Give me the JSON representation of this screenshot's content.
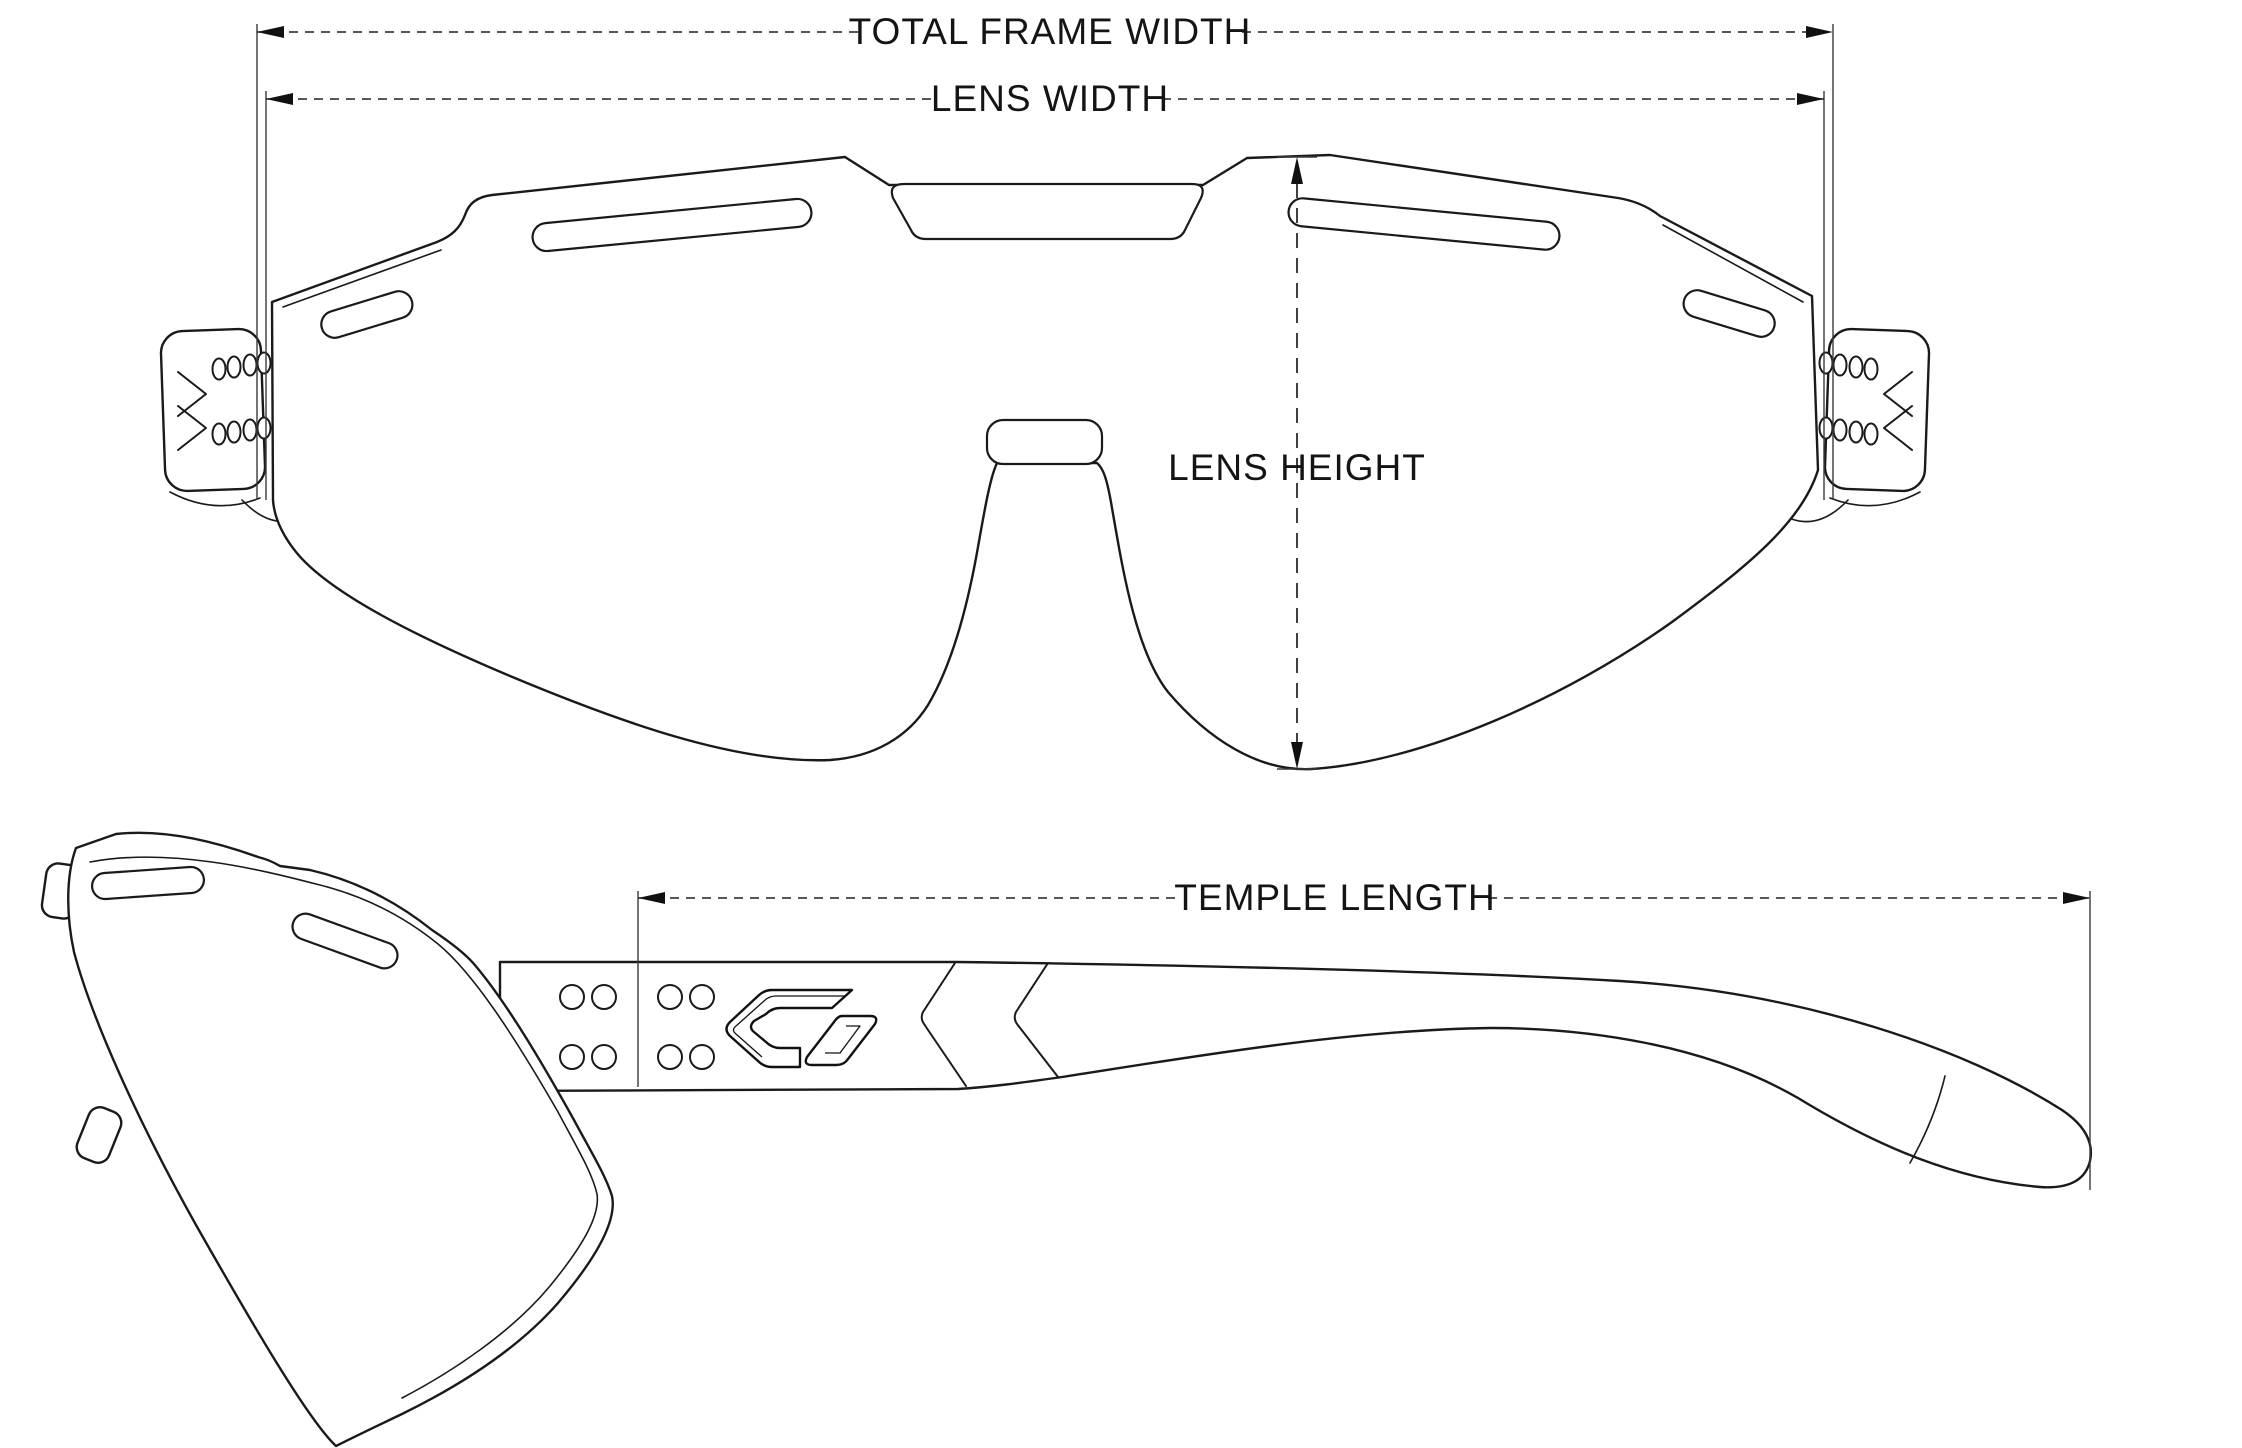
{
  "page": {
    "background_color": "#ffffff",
    "line_color": "#1a1a1a"
  },
  "drawing": {
    "type": "technical-dimension-diagram",
    "subject": "sport sunglasses frame, front view and side view line drawing",
    "labels": {
      "total_frame_width": "TOTAL FRAME WIDTH",
      "lens_width": "LENS WIDTH",
      "lens_height": "LENS HEIGHT",
      "temple_length": "TEMPLE LENGTH"
    },
    "icons": {
      "brand_logo": "gatorz-chevron-logo",
      "hinge_marks": "double-chevron-icon"
    }
  }
}
